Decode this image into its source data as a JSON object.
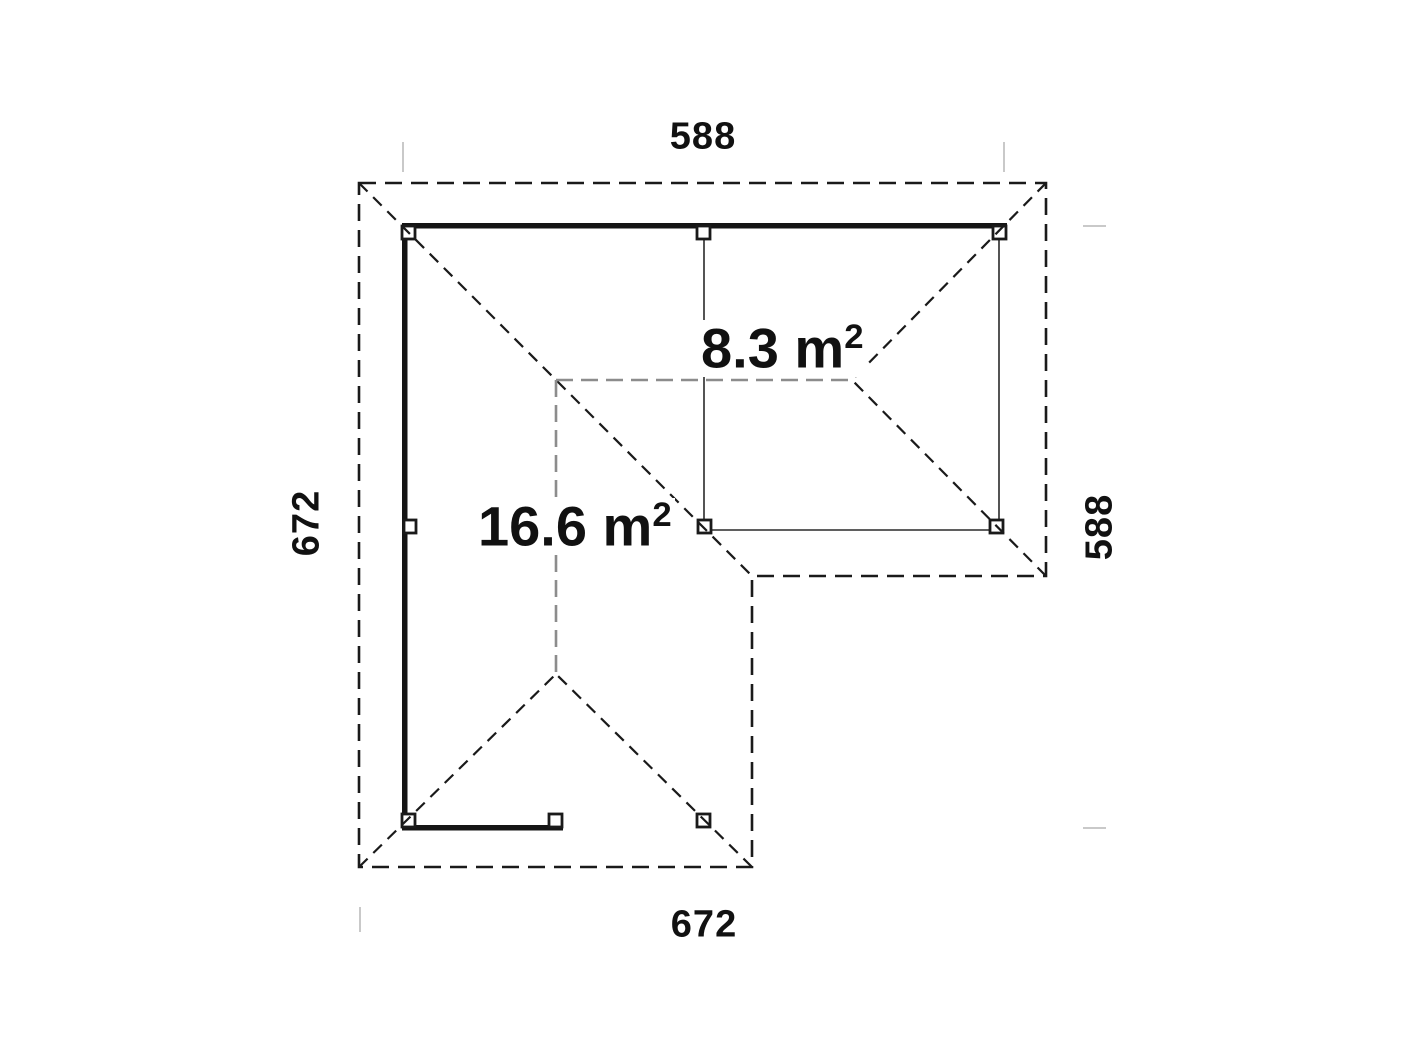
{
  "plan": {
    "dimensions": {
      "top": "588",
      "right": "588",
      "bottom": "672",
      "left": "672"
    },
    "areas": {
      "right_room": {
        "main": "8.3 m",
        "exp": "2"
      },
      "main_room": {
        "main": "16.6 m",
        "exp": "2"
      }
    },
    "colors": {
      "background": "#ffffff",
      "label": "#111111",
      "outline": "#1a1a1a",
      "wall": "#151515",
      "beam": "#2a2a2a",
      "ridge": "#8c8c8c",
      "tick": "#c9c9c9"
    }
  }
}
